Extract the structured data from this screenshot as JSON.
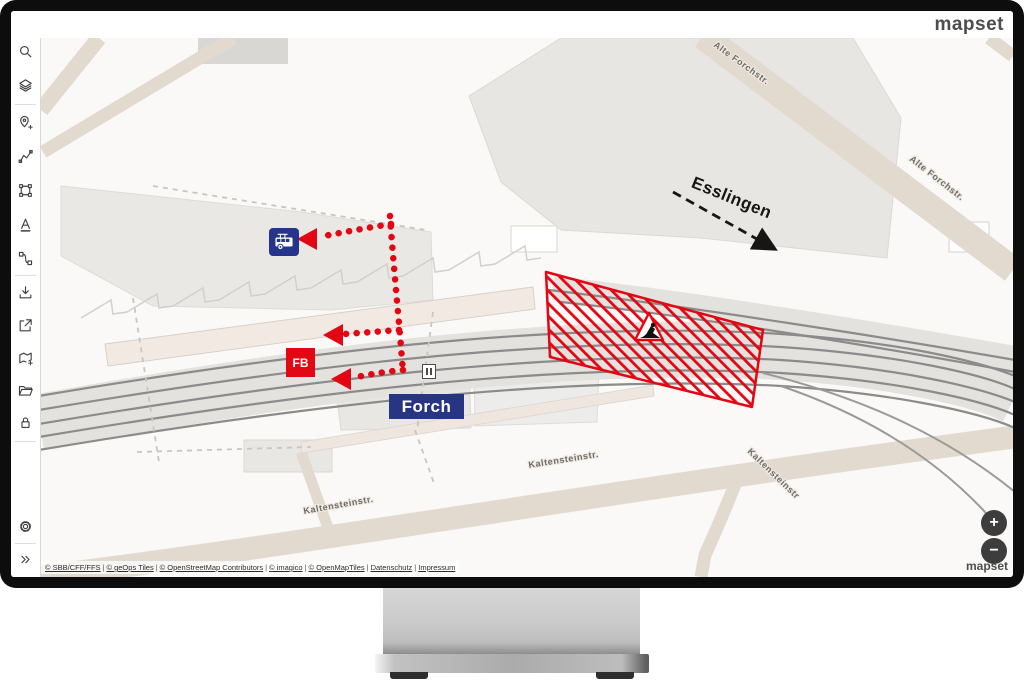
{
  "header": {
    "logo": "mapset"
  },
  "sidebar": {
    "icons": [
      "search",
      "layers",
      "add-location",
      "draw-line",
      "select-polygon",
      "text",
      "route",
      "download",
      "share",
      "add-map",
      "open-folder",
      "lock",
      "settings",
      "expand"
    ]
  },
  "map": {
    "station_label": "Forch",
    "platform_marker": "FB",
    "direction_label": "Esslingen",
    "streets": {
      "alte_forchstr_top": "Alte Forchstr.",
      "alte_forchstr_right": "Alte Forchstr.",
      "kaltensteinstr_left": "Kaltensteinstr.",
      "kaltensteinstr_mid": "Kaltensteinstr.",
      "kaltensteinstr_right": "Kaltensteinstr"
    },
    "colors": {
      "annotation_red": "#e30613",
      "label_navy": "#283583",
      "bus_blue": "#27348b"
    }
  },
  "controls": {
    "zoom_in": "+",
    "zoom_out": "−",
    "watermark": "mapset"
  },
  "attribution": {
    "separator": "|",
    "links": [
      "© SBB/CFF/FFS",
      "© geOps Tiles",
      "© OpenStreetMap Contributors",
      "© imagico",
      "© OpenMapTiles",
      "Datenschutz",
      "Impressum"
    ]
  }
}
